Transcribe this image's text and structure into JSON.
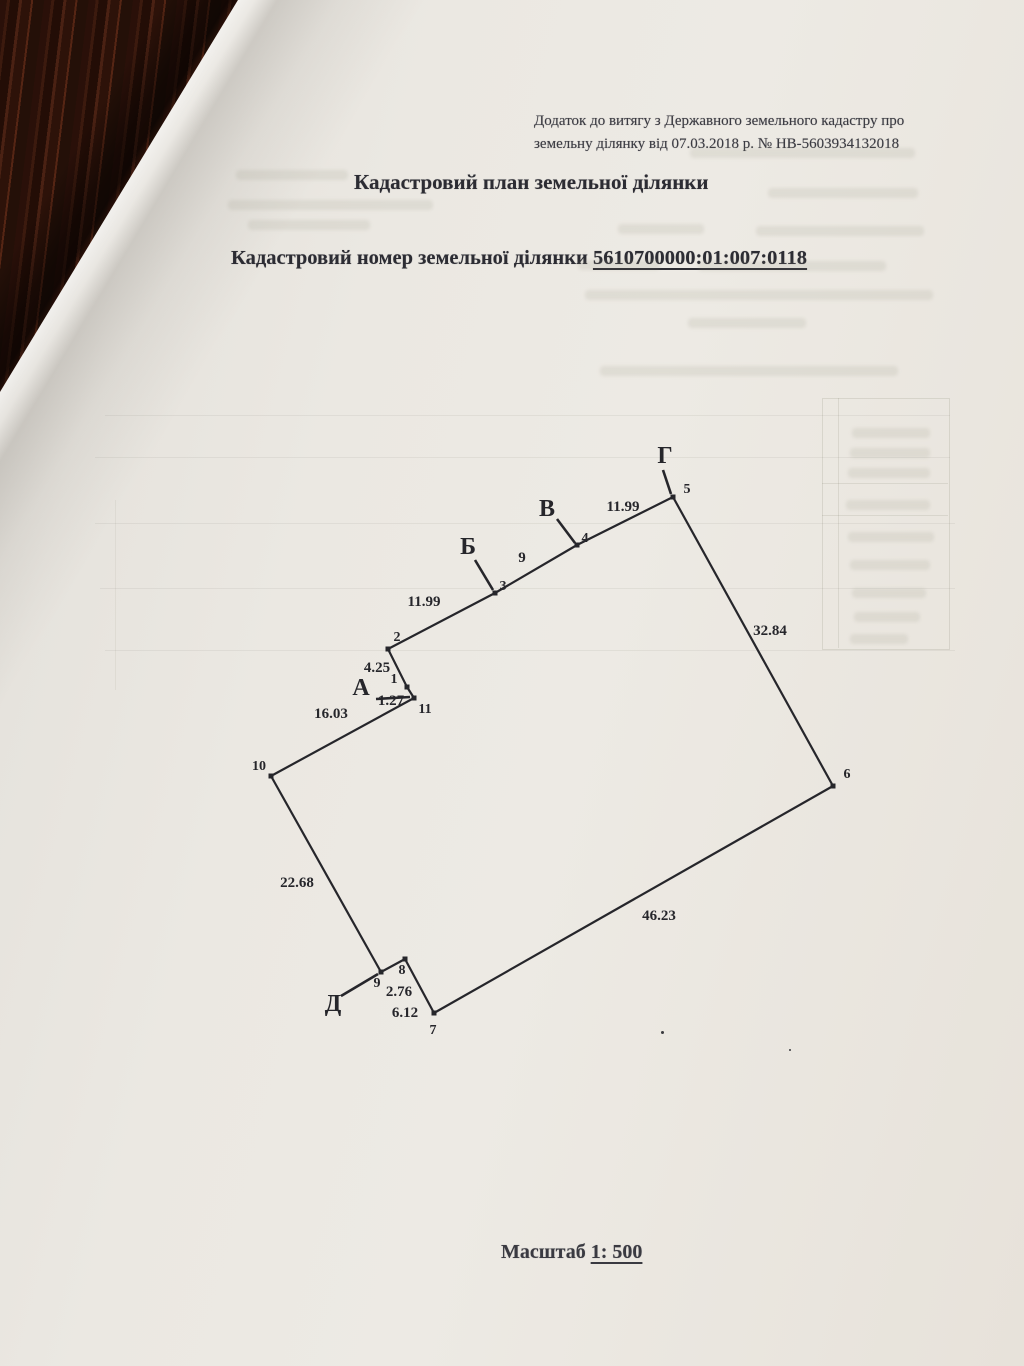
{
  "document": {
    "header_line1": "Додаток до витягу з Державного земельного кадастру про",
    "header_line2": "земельну ділянку від 07.03.2018 р. № НВ-5603934132018",
    "title": "Кадастровий план земельної ділянки",
    "cadastral_label": "Кадастровий номер земельної ділянки",
    "cadastral_number": "5610700000:01:007:0118",
    "scale_label": "Масштаб",
    "scale_value": "1: 500"
  },
  "diagram": {
    "type": "cadastral-parcel-plan",
    "ink": "#26262b",
    "stroke_width": 2.2,
    "points": [
      {
        "id": "1",
        "x": 407,
        "y": 687,
        "label_x": 394,
        "label_y": 683
      },
      {
        "id": "2",
        "x": 388,
        "y": 649,
        "label_x": 397,
        "label_y": 641
      },
      {
        "id": "3",
        "x": 495,
        "y": 593,
        "label_x": 503,
        "label_y": 590
      },
      {
        "id": "4",
        "x": 577,
        "y": 545,
        "label_x": 585,
        "label_y": 542
      },
      {
        "id": "5",
        "x": 673,
        "y": 497,
        "label_x": 687,
        "label_y": 493
      },
      {
        "id": "6",
        "x": 833,
        "y": 786,
        "label_x": 847,
        "label_y": 778
      },
      {
        "id": "7",
        "x": 434,
        "y": 1013,
        "label_x": 433,
        "label_y": 1034
      },
      {
        "id": "8",
        "x": 405,
        "y": 959,
        "label_x": 402,
        "label_y": 974
      },
      {
        "id": "9",
        "x": 381,
        "y": 972,
        "label_x": 377,
        "label_y": 987
      },
      {
        "id": "10",
        "x": 271,
        "y": 776,
        "label_x": 259,
        "label_y": 770
      },
      {
        "id": "11",
        "x": 414,
        "y": 698,
        "label_x": 425,
        "label_y": 713
      }
    ],
    "segments": [
      {
        "from": "1",
        "to": "2",
        "length": "4.25",
        "label_x": 377,
        "label_y": 672
      },
      {
        "from": "2",
        "to": "3",
        "length": "11.99",
        "label_x": 424,
        "label_y": 606
      },
      {
        "from": "3",
        "to": "4",
        "length": "9",
        "label_x": 522,
        "label_y": 562
      },
      {
        "from": "4",
        "to": "5",
        "length": "11.99",
        "label_x": 623,
        "label_y": 511
      },
      {
        "from": "5",
        "to": "6",
        "length": "32.84",
        "label_x": 770,
        "label_y": 635
      },
      {
        "from": "6",
        "to": "7",
        "length": "46.23",
        "label_x": 659,
        "label_y": 920
      },
      {
        "from": "7",
        "to": "8",
        "length": "6.12",
        "label_x": 405,
        "label_y": 1017
      },
      {
        "from": "8",
        "to": "9",
        "length": "2.76",
        "label_x": 399,
        "label_y": 996
      },
      {
        "from": "9",
        "to": "10",
        "length": "22.68",
        "label_x": 297,
        "label_y": 887
      },
      {
        "from": "10",
        "to": "11",
        "length": "16.03",
        "label_x": 331,
        "label_y": 718
      },
      {
        "from": "11",
        "to": "1",
        "length": "1.27",
        "label_x": 391,
        "label_y": 705
      }
    ],
    "corner_letters": [
      {
        "letter": "А",
        "x": 361,
        "y": 695,
        "leader": [
          376,
          699,
          410,
          697
        ]
      },
      {
        "letter": "Б",
        "x": 468,
        "y": 554,
        "leader": [
          475,
          560,
          493,
          590
        ]
      },
      {
        "letter": "В",
        "x": 547,
        "y": 516,
        "leader": [
          557,
          519,
          575,
          543
        ]
      },
      {
        "letter": "Г",
        "x": 665,
        "y": 463,
        "leader": [
          663,
          470,
          671,
          494
        ]
      },
      {
        "letter": "Д",
        "x": 333,
        "y": 1011,
        "leader": [
          341,
          996,
          378,
          974
        ]
      }
    ]
  },
  "bleedthrough": {
    "rows": [
      [
        690,
        148,
        225
      ],
      [
        768,
        188,
        150
      ],
      [
        618,
        224,
        86
      ],
      [
        756,
        226,
        168
      ],
      [
        578,
        260,
        82
      ],
      [
        698,
        261,
        188
      ],
      [
        585,
        290,
        348
      ],
      [
        688,
        318,
        118
      ],
      [
        236,
        170,
        112
      ],
      [
        228,
        200,
        205
      ],
      [
        248,
        220,
        122
      ],
      [
        600,
        366,
        298
      ],
      [
        852,
        428,
        78
      ],
      [
        850,
        448,
        80
      ],
      [
        848,
        468,
        82
      ],
      [
        846,
        500,
        84
      ],
      [
        848,
        532,
        86
      ],
      [
        850,
        560,
        80
      ],
      [
        852,
        588,
        74
      ],
      [
        854,
        612,
        66
      ],
      [
        850,
        634,
        58
      ]
    ],
    "hlines": [
      [
        105,
        415,
        845
      ],
      [
        95,
        457,
        855
      ],
      [
        95,
        523,
        860
      ],
      [
        100,
        588,
        855
      ],
      [
        105,
        650,
        850
      ]
    ],
    "vlines": [
      [
        115,
        500,
        190
      ]
    ],
    "table_box": [
      822,
      398,
      126,
      250
    ],
    "table_col_divider": [
      838,
      398,
      250
    ],
    "table_row_dividers": [
      [
        822,
        483,
        126
      ],
      [
        822,
        515,
        126
      ]
    ],
    "specks": [
      [
        661,
        1031,
        3
      ],
      [
        789,
        1049,
        2
      ]
    ]
  }
}
